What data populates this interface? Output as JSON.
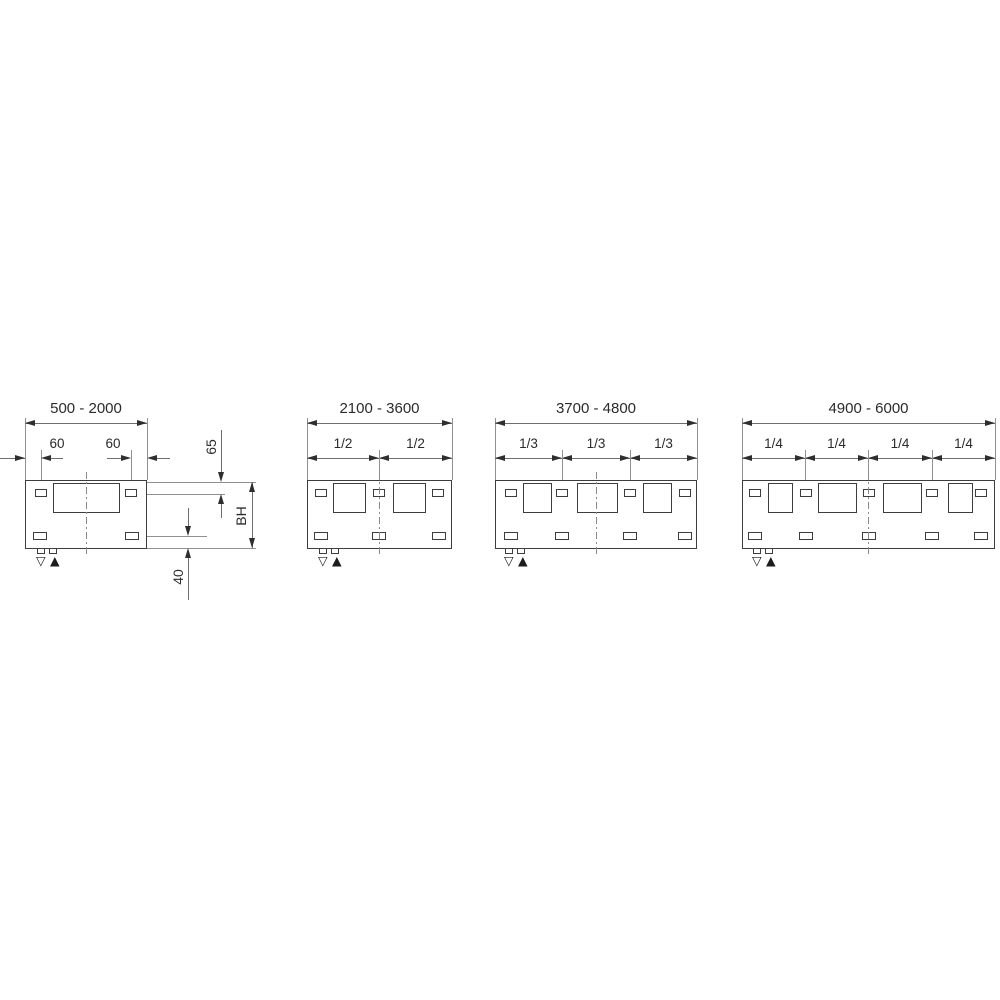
{
  "panels": [
    {
      "range": "500 - 2000",
      "offset_left": "60",
      "offset_right": "60",
      "top_fix": "65",
      "build_height": "BH",
      "bottom_fix": "40"
    },
    {
      "range": "2100 - 3600",
      "fractions": [
        "1/2",
        "1/2"
      ]
    },
    {
      "range": "3700 - 4800",
      "fractions": [
        "1/3",
        "1/3",
        "1/3"
      ]
    },
    {
      "range": "4900 - 6000",
      "fractions": [
        "1/4",
        "1/4",
        "1/4",
        "1/4"
      ]
    }
  ],
  "symbols": {
    "flow": "▽",
    "return": "▲"
  },
  "colors": {
    "outline": "#3d3d3d",
    "dim_line": "#6e6e6e",
    "extension_line": "#919191",
    "text": "#2b2b2b"
  }
}
